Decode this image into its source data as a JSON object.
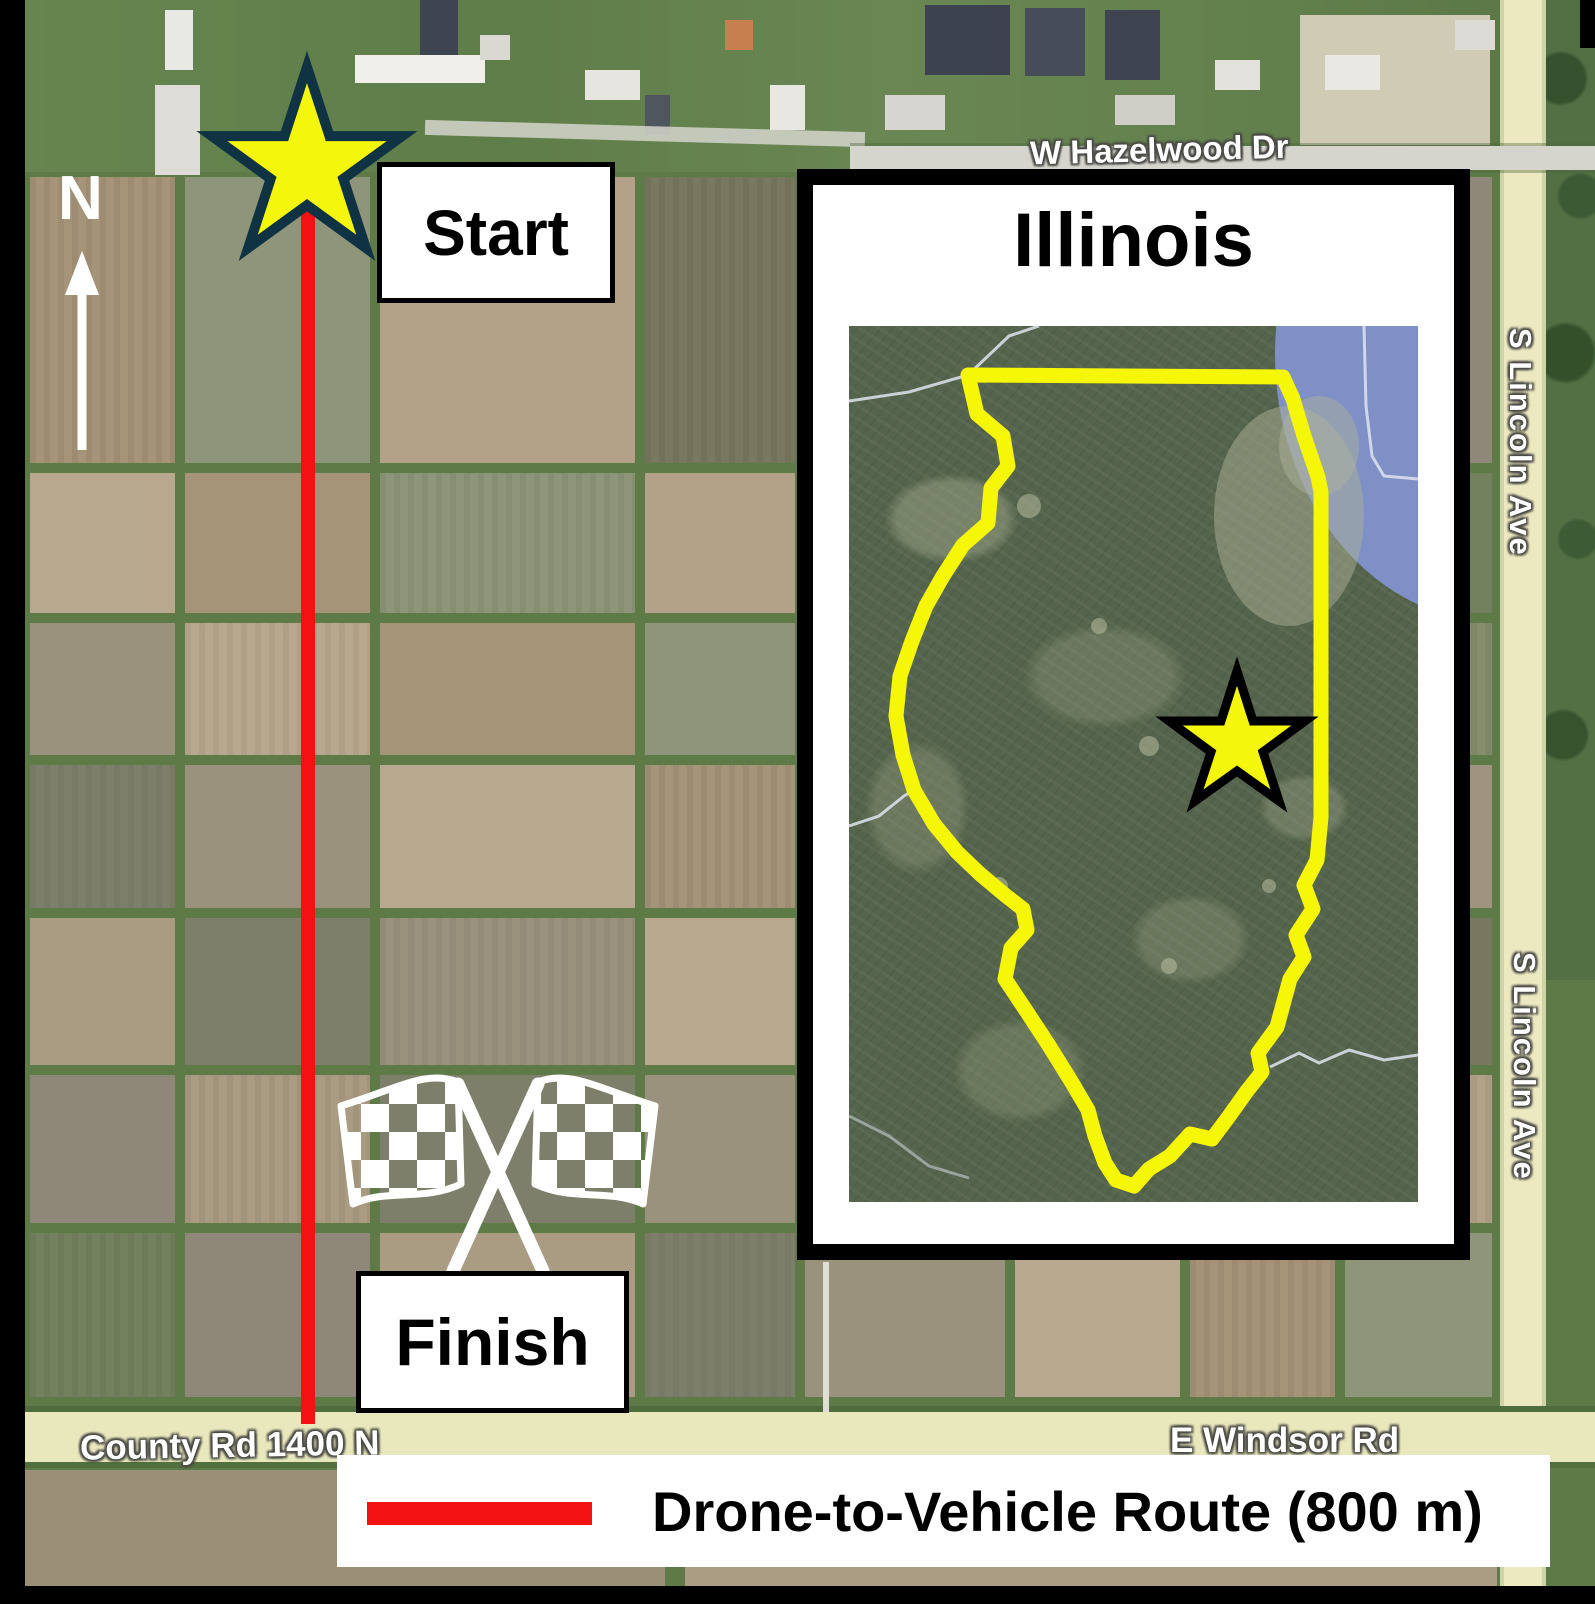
{
  "markers": {
    "start_label": "Start",
    "finish_label": "Finish"
  },
  "compass": {
    "north_label": "N"
  },
  "inset": {
    "title": "Illinois"
  },
  "road_labels": {
    "hazelwood": "W Hazelwood Dr",
    "lincoln_upper": "S Lincoln Ave",
    "lincoln_lower": "S Lincoln Ave",
    "county_rd": "County Rd 1400 N",
    "windsor": "E Windsor Rd"
  },
  "legend": {
    "route_label": "Drone-to-Vehicle Route (800 m)"
  },
  "colors": {
    "route_red": "#f31111",
    "star_yellow": "#f4f60c",
    "star_outline_main": "#0f3342",
    "star_outline_inset": "#000000",
    "illinois_outline_yellow": "#f6f607",
    "lake_blue": "#7e90c5"
  }
}
